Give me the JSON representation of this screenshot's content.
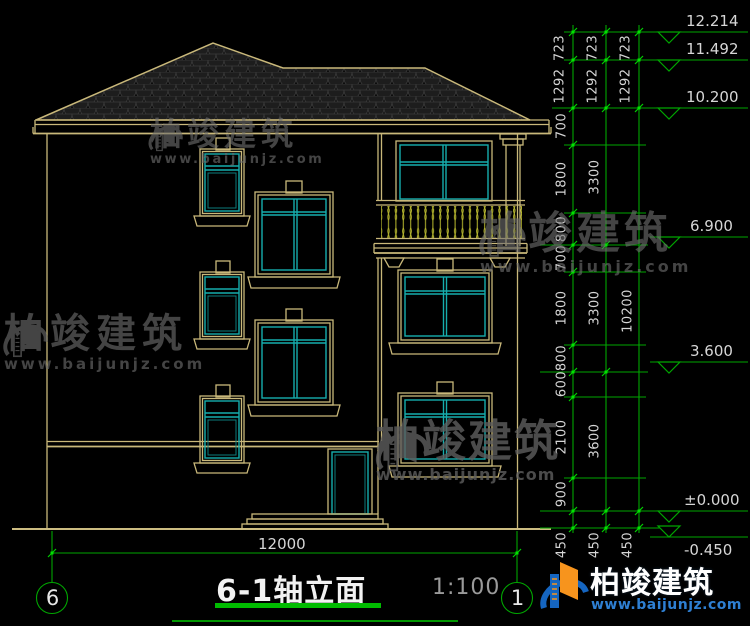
{
  "title_block": {
    "title": "6-1轴立面",
    "scale": "1:100"
  },
  "axes": {
    "left": "6",
    "right": "1"
  },
  "ground_dim": "12000",
  "roof_dims": {
    "upper": [
      "723",
      "723",
      "723"
    ],
    "lower": [
      "1292",
      "1292",
      "1292"
    ]
  },
  "chains": {
    "c1": [
      "700",
      "1800",
      "800",
      "700",
      "1800",
      "800",
      "600",
      "2100",
      "900",
      "450"
    ],
    "c2": [
      "3300",
      "3300",
      "3600",
      "450"
    ],
    "c3": [
      "10200",
      "450"
    ]
  },
  "levels": [
    "12.214",
    "11.492",
    "10.200",
    "6.900",
    "3.600",
    "±0.000",
    "-0.450"
  ],
  "watermark": {
    "name": "柏竣建筑",
    "url": "www.baijunjz.com"
  },
  "logo": {
    "name": "柏竣建筑",
    "url": "www.baijunjz.com"
  },
  "colors": {
    "line_tan": "#c9b87a",
    "window_cyan": "#16adad",
    "dim_green": "#00a600",
    "node_green": "#00e400",
    "baluster_yellow": "#b9b92f",
    "logo_blue": "#1565c0",
    "logo_orange": "#f7941d",
    "title_underline": "#00bb00"
  }
}
